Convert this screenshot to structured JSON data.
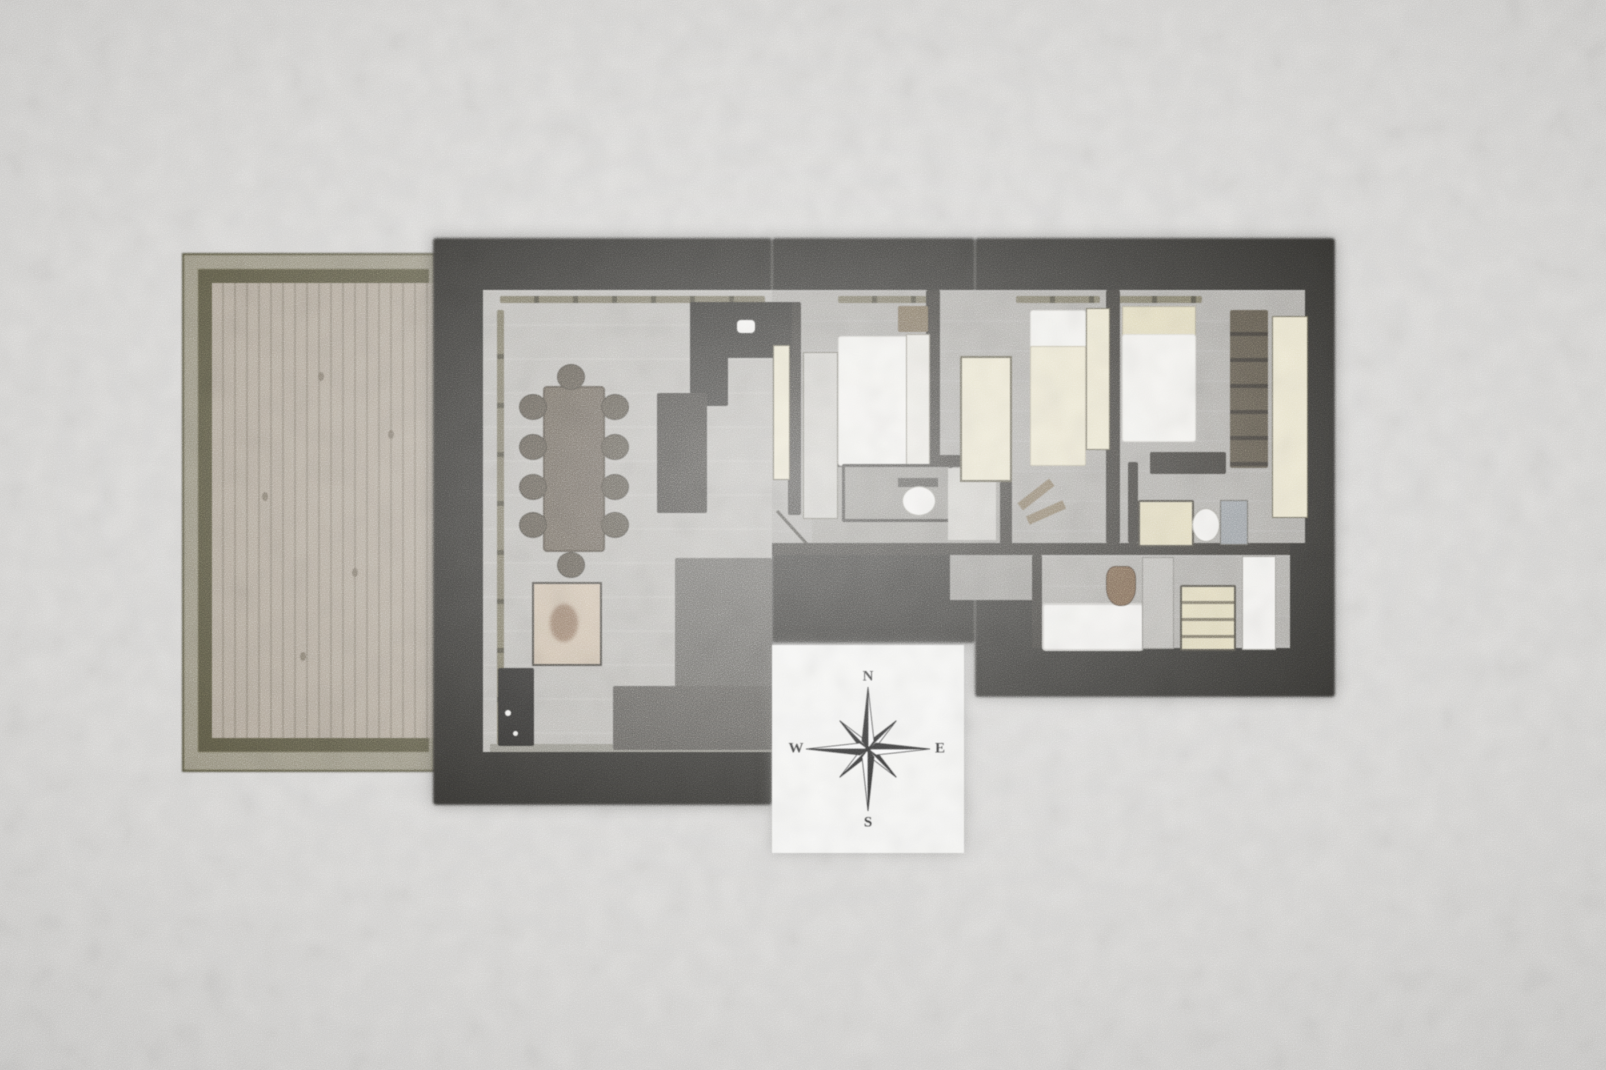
{
  "scene": {
    "kind": "watercolor-architectural-floor-plan",
    "orientation_marker": "compass-rose"
  },
  "compass": {
    "north": "N",
    "east": "E",
    "south": "S",
    "west": "W"
  },
  "rooms": [
    {
      "name": "terrace-deck"
    },
    {
      "name": "living-dining-room"
    },
    {
      "name": "kitchen"
    },
    {
      "name": "bedroom-1"
    },
    {
      "name": "bathroom-1"
    },
    {
      "name": "bedroom-2"
    },
    {
      "name": "bedroom-3"
    },
    {
      "name": "shower-room"
    },
    {
      "name": "bathroom-2"
    },
    {
      "name": "hallway"
    }
  ],
  "furniture_counts": {
    "dining_chairs": 10,
    "beds": 3,
    "sofa_sections": 2,
    "toilets": 2,
    "bathtubs": 1,
    "wardrobes": 4
  },
  "palette": {
    "paper": "#d7d6d4",
    "wall": "#21201d",
    "interior_wall": "#2a2824",
    "floor_living": "#b4b2ad",
    "floor_hall": "#a5a39e",
    "floor_corridor": "#95938e",
    "terrace_wood": "#ada395",
    "terrace_wood_line": "#938a7b",
    "terrace_frame_light": "#96917e",
    "terrace_frame_dark": "#54513d",
    "window_olive": "#6e6852",
    "window_tick": "#3e3b2e",
    "cream": "#e9e3c9",
    "cream_dark": "#ded6b4",
    "linen": "#f2f1ed",
    "furniture_dark": "#2b2925",
    "counter_dark": "#1f1e1b",
    "sofa_gray": "#585651",
    "sofa_gray_2": "#4e4c48",
    "wood_tan": "#8a7355",
    "nightstand_tan": "#6f5f46",
    "art_beige": "#c7b6a0",
    "art_figure": "#8d6f55",
    "shelf_light": "#cac8c2",
    "shower_gray": "#8f959a",
    "plant_brown": "#6b4f38",
    "bath_white": "#f2f1ee",
    "compass_bg": "#f5f5f3",
    "compass_ink": "#1b1b1b"
  }
}
